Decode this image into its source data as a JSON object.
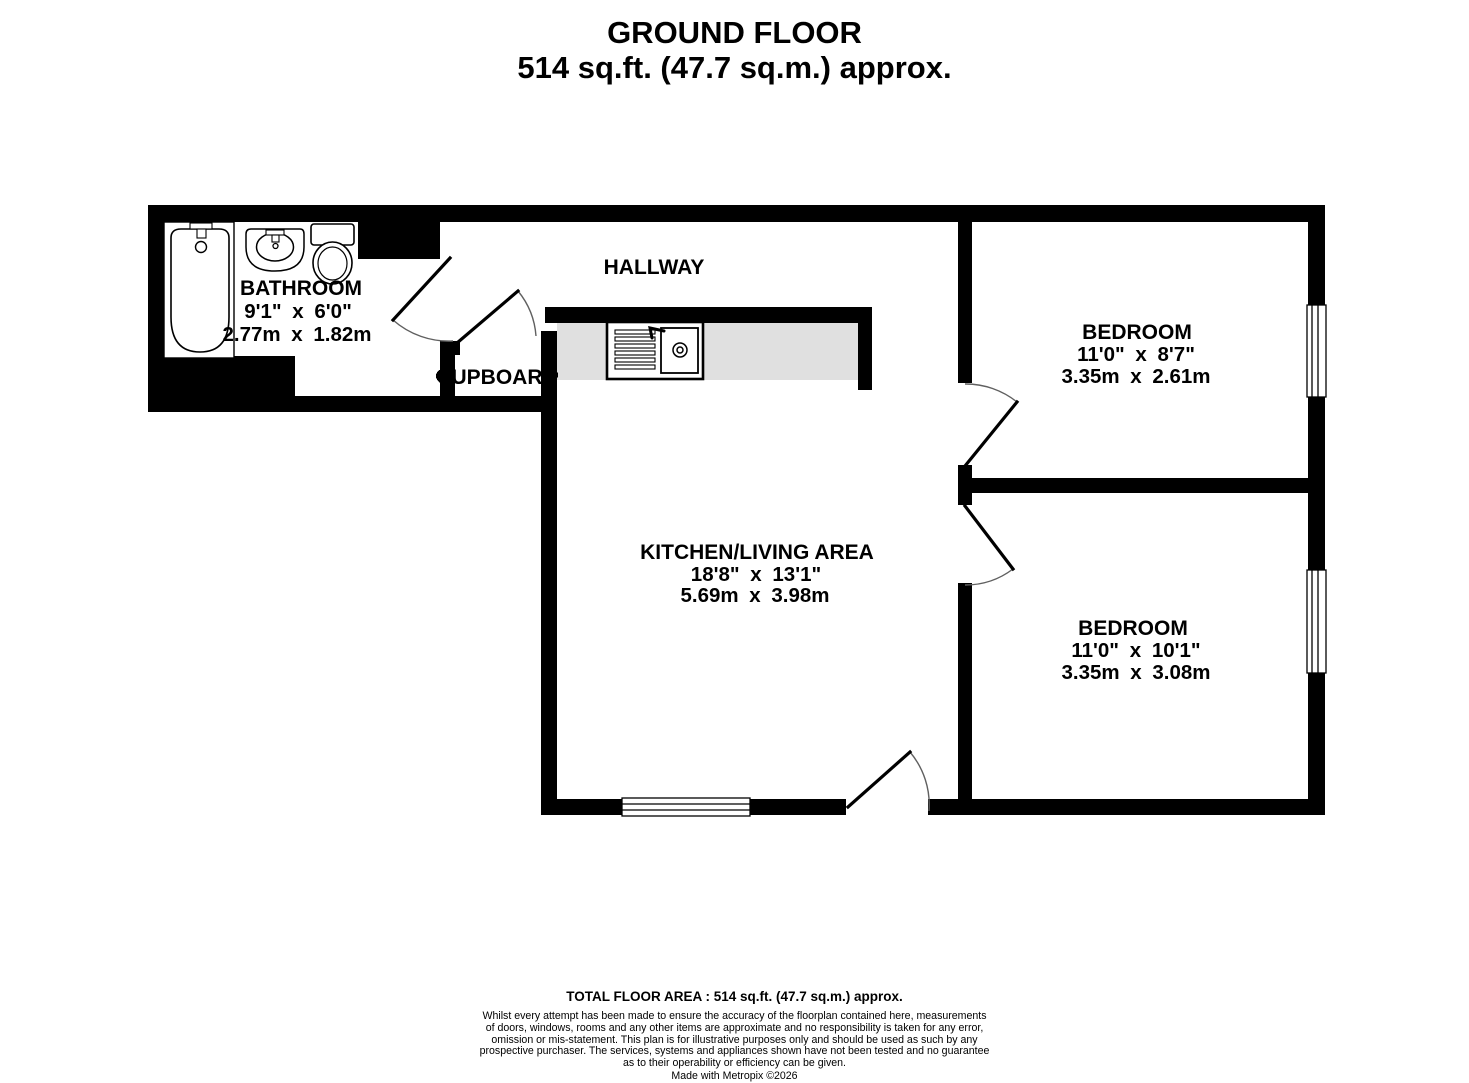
{
  "title": {
    "line1": "GROUND FLOOR",
    "line2": "514 sq.ft. (47.7 sq.m.) approx."
  },
  "rooms": {
    "hallway": {
      "name": "HALLWAY"
    },
    "bathroom": {
      "name": "BATHROOM",
      "imperial": "9'1\" x 6'0\"",
      "metric": "2.77m x 1.82m"
    },
    "cupboard": {
      "name": "CUPBOARD"
    },
    "kitchen_living": {
      "name": "KITCHEN/LIVING AREA",
      "imperial": "18'8\" x 13'1\"",
      "metric": "5.69m x 3.98m"
    },
    "bedroom_top": {
      "name": "BEDROOM",
      "imperial": "11'0\" x 8'7\"",
      "metric": "3.35m x 2.61m"
    },
    "bedroom_bottom": {
      "name": "BEDROOM",
      "imperial": "11'0\" x 10'1\"",
      "metric": "3.35m x 3.08m"
    }
  },
  "footer": {
    "total": "TOTAL FLOOR AREA : 514 sq.ft. (47.7 sq.m.) approx.",
    "disclaimer_lines": [
      "Whilst every attempt has been made to ensure the accuracy of the floorplan contained here, measurements",
      "of doors, windows, rooms and any other items are approximate and no responsibility is taken for any error,",
      "omission or mis-statement. This plan is for illustrative purposes only and should be used as such by any",
      "prospective purchaser. The services, systems and appliances shown have not been tested and no guarantee",
      "as to their operability or efficiency can be given."
    ],
    "credit": "Made with Metropix ©2026"
  },
  "colors": {
    "wall": "#000000",
    "floor": "#ffffff",
    "counter": "#e0e0e0",
    "door_arc": "#606060"
  }
}
